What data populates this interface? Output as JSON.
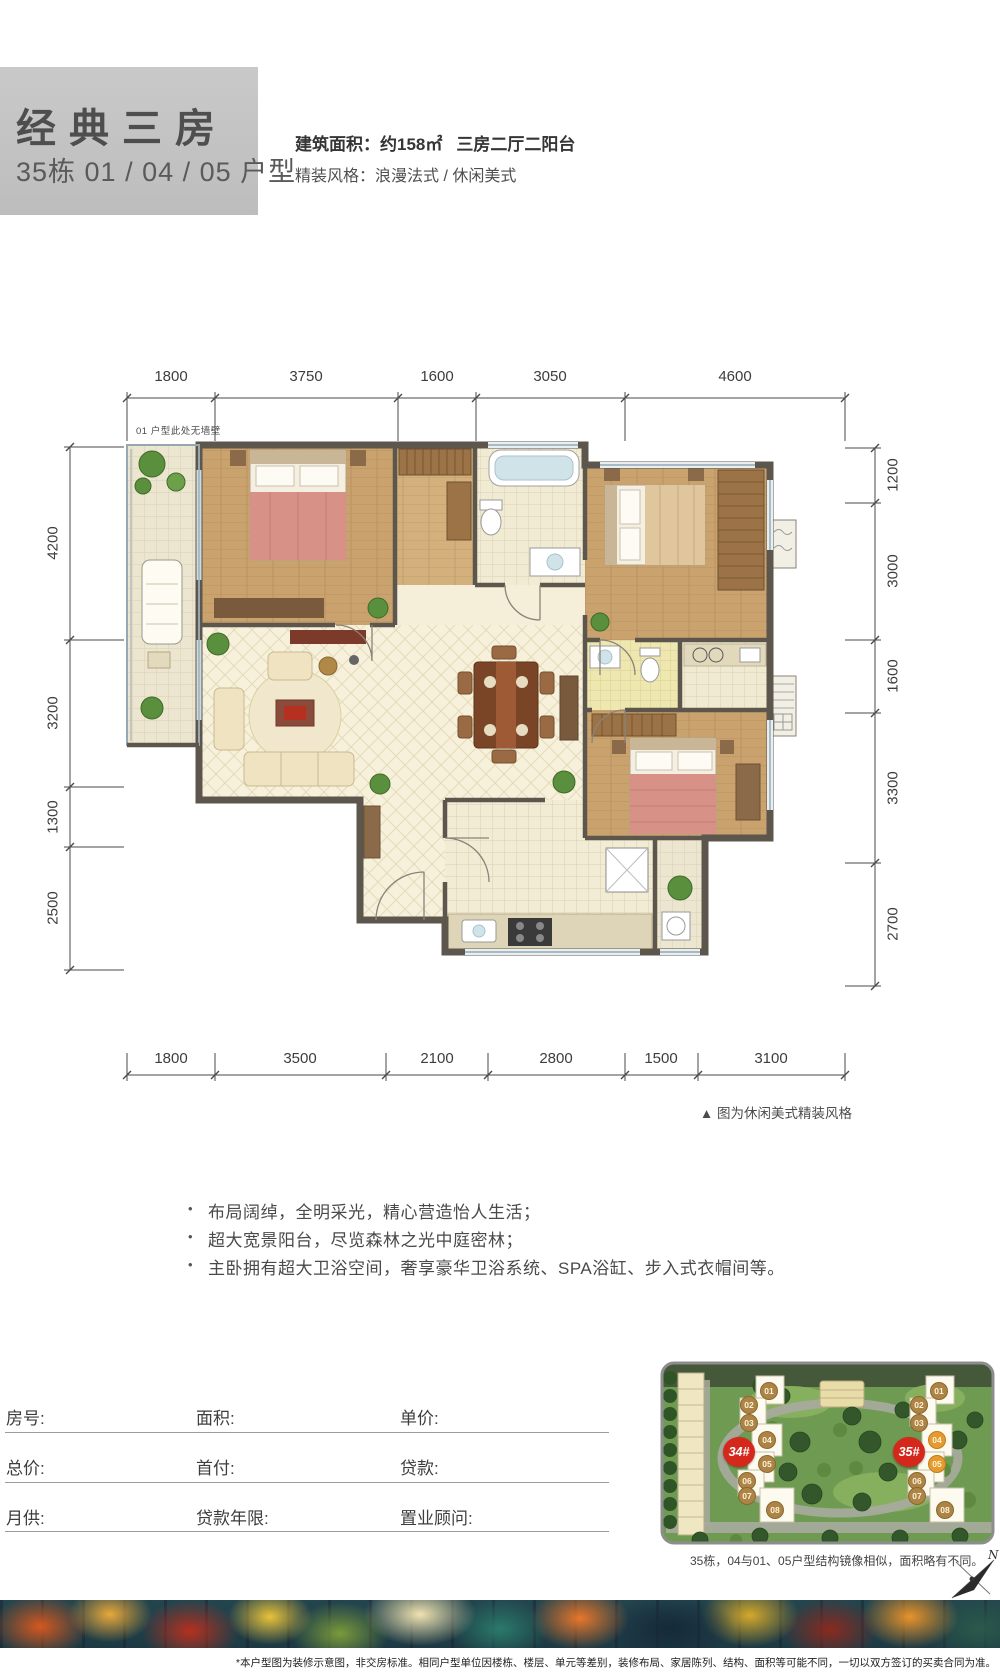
{
  "header": {
    "title": "经典三房",
    "subtitle": "35栋 01 / 04 / 05 户型",
    "area_label": "建筑面积：",
    "area_value": "约158㎡",
    "rooms_value": "三房二厅二阳台",
    "style_label": "精装风格：",
    "style_value": "浪漫法式 / 休闲美式"
  },
  "floorplan": {
    "wall_note": "01 户型此处无墙壁",
    "caption": "▲ 图为休闲美式精装风格",
    "dims_top": [
      "1800",
      "3750",
      "1600",
      "3050",
      "4600"
    ],
    "dims_bottom": [
      "1800",
      "3500",
      "2100",
      "2800",
      "1500",
      "3100"
    ],
    "dims_left": [
      "4200",
      "3200",
      "1300",
      "2500"
    ],
    "dims_right": [
      "1200",
      "3000",
      "1600",
      "3300",
      "2700"
    ]
  },
  "icons": {
    "bullet": "•"
  },
  "features": [
    "布局阔绰，全明采光，精心营造怡人生活；",
    "超大宽景阳台，尽览森林之光中庭密林；",
    "主卧拥有超大卫浴空间，奢享豪华卫浴系统、SPA浴缸、步入式衣帽间等。"
  ],
  "form": {
    "rows": [
      [
        "房号:",
        "面积:",
        "单价:"
      ],
      [
        "总价:",
        "首付:",
        "贷款:"
      ],
      [
        "月供:",
        "贷款年限:",
        "置业顾问:"
      ]
    ]
  },
  "siteplan": {
    "building_left": "34#",
    "building_right": "35#",
    "units": [
      "01",
      "02",
      "03",
      "04",
      "05",
      "06",
      "07",
      "08"
    ],
    "caption": "35栋，04与01、05户型结构镜像相似，面积略有不同。",
    "compass_label": "N"
  },
  "disclaimer": "*本户型图为装修示意图，非交房标准。相同户型单位因楼栋、楼层、单元等差别，装修布局、家居陈列、结构、面积等可能不同，一切以双方签订的买卖合同为准。",
  "colors": {
    "accent_red": "#d5281c",
    "badge_tan": "#ad8446",
    "badge_highlight": "#e59b2f"
  }
}
